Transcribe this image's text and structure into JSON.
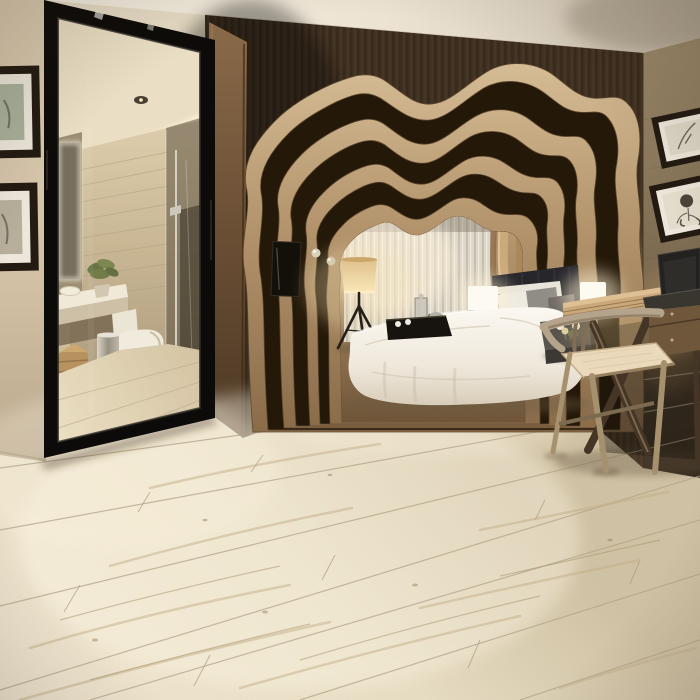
{
  "scene": {
    "caption": "Modern bedroom interior photo: layered organic wood arch alcove framing a white bed with gray pillows and a serving tray, sheer curtain and tripod floor lamp inside the alcove, tall black-framed leaning mirror reflecting an en-suite bathroom with travertine walls, vanity, toilet and glass shower, two botanical prints on the right wall above a wood writing desk with a laptop and a wishbone chair, all over light cream wood-look plank flooring"
  },
  "labels": {
    "ceiling": "Ceiling",
    "leftWall": "Left wall",
    "archWall": "Dark wood slat wall",
    "rightWall": "Right wall",
    "floor": "Wood-look plank floor",
    "mirror": "Leaning mirror with bathroom reflection",
    "bathroom": "En-suite bathroom reflection",
    "framesLeft": "Framed prints on left wall",
    "framesRight": "Botanical prints on right wall",
    "arch": "Layered organic wood arch alcove",
    "curtain": "Sheer curtain",
    "wallArt": "Dark wall art panel in alcove",
    "sconces": "Glass ball sconces",
    "floorLamp": "Tripod floor lamp",
    "bed": "Bed with white duvet",
    "headboard": "Dark upholstered headboard",
    "pillows": "Pillow arrangement",
    "tray": "Black serving tray with tea set",
    "lampLeft": "Glowing cube bedside lamp (left)",
    "lampRight": "Glowing cube bedside lamp (right)",
    "nightstand": "Dark side table with flowers",
    "desk": "Wood writing desk",
    "laptop": "Open laptop",
    "chair": "Wishbone chair"
  },
  "colors": {
    "ceiling-light": "#f7f1e4",
    "ceiling-dark": "#d8cdba",
    "wall-left": "#d8c7ac",
    "slat-dark": "#4a3928",
    "slat-mid": "#5a4733",
    "wall-right-top": "#958266",
    "wall-right-bottom": "#4e4030",
    "wood-column": "#6b4f35",
    "floor-base": "#e6dcc4",
    "floor-seam": "#b3a489",
    "floor-grain": "#c4b08a",
    "arch-wood-light": "#d6bd96",
    "arch-wood-dark": "#8a6c4a",
    "arch-gap": "#241808",
    "interior-wood": "#b1935f",
    "curtain": "#dcd6c9",
    "duvet": "#f7f3ea",
    "headboard": "#26262b",
    "frame-dark": "#231b12",
    "mat-white": "#ece7da",
    "lamp-glow": "#f7e4b4",
    "steel": "#b5b0a3",
    "travertine": "#c8b694"
  }
}
